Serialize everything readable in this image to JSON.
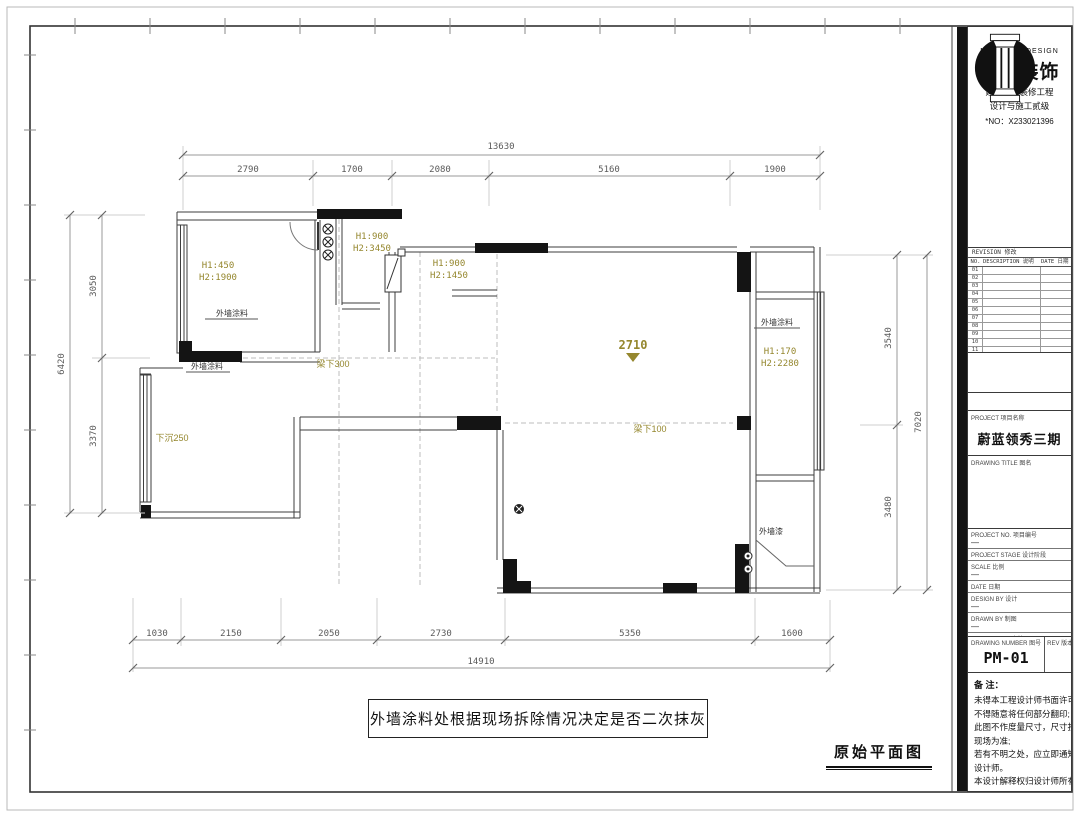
{
  "drawing": {
    "plan_title": "原始平面图",
    "note_box": "外墙涂料处根据现场拆除情况决定是否二次抹灰",
    "dims": {
      "top_total": "13630",
      "top_segments": [
        "2790",
        "1700",
        "2080",
        "5160",
        "1900"
      ],
      "bottom_segments": [
        "1030",
        "2150",
        "2050",
        "2730",
        "5350",
        "1600"
      ],
      "bottom_total": "14910",
      "left_total": "6420",
      "left_segments": [
        "3050",
        "3370"
      ],
      "right_segments": [
        "3540",
        "3480"
      ],
      "right_total": "7020"
    },
    "annotations": {
      "height_mark": "2710",
      "win_balcony_l1": "H1:450",
      "win_balcony_l2": "H2:1900",
      "win_entry_l1": "H1:900",
      "win_entry_l2": "H2:3450",
      "win_hall_l1": "H1:900",
      "win_hall_l2": "H2:1450",
      "win_right_l1": "H1:170",
      "win_right_l2": "H2:2280",
      "beam_300": "梁下300",
      "beam_100": "梁下100",
      "sunken": "下沉250",
      "ext_paint_1": "外墙涂料",
      "ext_paint_2": "外墙涂料",
      "ext_paint_3": "外墙涂料",
      "ext_paint_4": "外墙漆"
    }
  },
  "titleblock": {
    "logo_caption": "NANHONG DESIGN",
    "company": "南鸿装饰",
    "cert_line1": "建筑装饰装修工程",
    "cert_line2": "设计与施工贰级",
    "cert_no": "*NO：X233021396",
    "revision": {
      "title": "REVISION 修改",
      "col_no": "NO.",
      "col_desc": "DESCRIPTION 说明",
      "col_date": "DATE 日期",
      "rows": [
        "01",
        "02",
        "03",
        "04",
        "05",
        "06",
        "07",
        "08",
        "09",
        "10",
        "11",
        "12"
      ]
    },
    "project_label": "PROJECT 项目名称",
    "project_name": "蔚蓝领秀三期",
    "drawing_title_label": "DRAWING TITLE 图名",
    "fields": [
      {
        "label": "PROJECT NO. 项目编号",
        "value": "—"
      },
      {
        "label": "PROJECT STAGE 设计阶段",
        "value": ""
      },
      {
        "label": "SCALE 比例",
        "value": "—"
      },
      {
        "label": "DATE 日期",
        "value": ""
      },
      {
        "label": "DESIGN BY 设计",
        "value": "—"
      },
      {
        "label": "DRAWN BY 制图",
        "value": "—"
      },
      {
        "label": "CHECKED BY 审核",
        "value": ""
      }
    ],
    "number_label": "DRAWING NUMBER 图号",
    "number_value": "PM-01",
    "rev_label": "REV 版本",
    "notes_title": "备 注：",
    "notes": [
      "未得本工程设计师书面许可",
      "不得随意将任何部分翻印;",
      "此图不作度量尺寸，尺寸按",
      "现场为准;",
      "若有不明之处，应立即通知",
      "设计师。",
      "本设计解释权归设计师所有"
    ]
  }
}
